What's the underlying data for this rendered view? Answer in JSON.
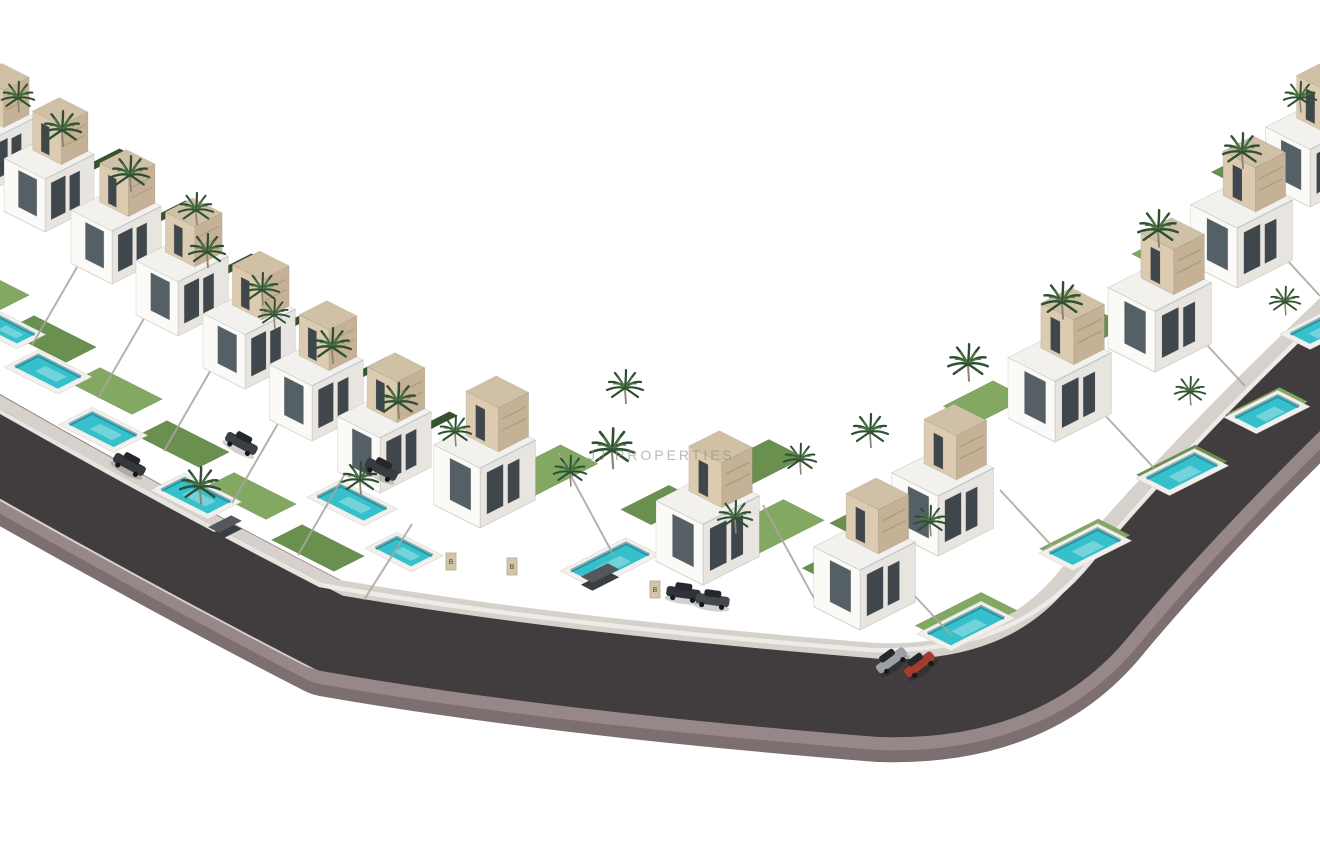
{
  "watermark": {
    "text": "JJ PROPERTIES",
    "color": "#8f8f8f"
  },
  "scene": {
    "background": "#ffffff",
    "road": {
      "path": "M -50 425 Q 140 535 330 633 Q 555 672 880 698 Q 1025 703 1100 610 Q 1200 490 1358 340",
      "surface_color": "#413d3f",
      "curb_color": "#978788",
      "curb_shadow_color": "#7d6e70",
      "sidewalk_color": "#d7d1cb",
      "wall_color": "#efede9"
    },
    "colors": {
      "villa_front": "#fbfaf7",
      "villa_side": "#e8e5e0",
      "villa_roof": "#f3f1ed",
      "tower_front": "#dccbb0",
      "tower_side": "#c5b195",
      "tower_top": "#d0c0a5",
      "window": "#3f464c",
      "window_light": "#545f66",
      "pool_water": "#35c0cb",
      "pool_deck": "#f2f0ed",
      "pool_shade": "rgba(13,104,121,0.5)",
      "lawn_light": "#83a862",
      "lawn_mid": "#69904e",
      "hedge": "#35522f",
      "palm": "#2e4f33",
      "palm_light": "#4e7a44",
      "trunk": "#8d8472",
      "fence": "#a9a5a0",
      "post": "#d3c5a8",
      "post_edge": "#b7a98c",
      "box_dark": "#3b3e41",
      "box_top": "#54585c",
      "wheel": "#17181a",
      "car_glass": "#24282c"
    },
    "villas": [
      {
        "x": -12,
        "y": 192,
        "s": 1.1
      },
      {
        "x": 1310,
        "y": 207,
        "s": 1.25
      },
      {
        "x": 45,
        "y": 232,
        "s": 1.15
      },
      {
        "x": 112,
        "y": 284,
        "s": 1.15
      },
      {
        "x": 1237,
        "y": 288,
        "s": 1.3
      },
      {
        "x": 178,
        "y": 336,
        "s": 1.18
      },
      {
        "x": 1155,
        "y": 372,
        "s": 1.32
      },
      {
        "x": 245,
        "y": 389,
        "s": 1.18
      },
      {
        "x": 312,
        "y": 441,
        "s": 1.2
      },
      {
        "x": 1055,
        "y": 442,
        "s": 1.32
      },
      {
        "x": 380,
        "y": 493,
        "s": 1.2
      },
      {
        "x": 480,
        "y": 528,
        "s": 1.3
      },
      {
        "x": 938,
        "y": 556,
        "s": 1.3
      },
      {
        "x": 703,
        "y": 585,
        "s": 1.32
      },
      {
        "x": 860,
        "y": 630,
        "s": 1.3
      }
    ],
    "pools": [
      {
        "x": 8,
        "y": 330,
        "a": 20,
        "b": 40
      },
      {
        "x": 48,
        "y": 372,
        "a": 26,
        "b": 48
      },
      {
        "x": 103,
        "y": 430,
        "a": 26,
        "b": 50
      },
      {
        "x": 196,
        "y": 496,
        "a": 26,
        "b": 52
      },
      {
        "x": 352,
        "y": 503,
        "a": 26,
        "b": 52
      },
      {
        "x": 404,
        "y": 552,
        "a": 24,
        "b": 40
      },
      {
        "x": 610,
        "y": 563,
        "a": 62,
        "b": 26
      },
      {
        "x": 966,
        "y": 626,
        "a": 60,
        "b": 26
      },
      {
        "x": 1085,
        "y": 547,
        "a": 54,
        "b": 26
      },
      {
        "x": 1182,
        "y": 472,
        "a": 54,
        "b": 26
      },
      {
        "x": 1267,
        "y": 412,
        "a": 48,
        "b": 24
      },
      {
        "x": 1318,
        "y": 330,
        "a": 40,
        "b": 22
      }
    ],
    "lawns": [
      {
        "x": 25,
        "y": 140,
        "a": 44,
        "b": 26,
        "tone": "mid"
      },
      {
        "x": 95,
        "y": 165,
        "a": 64,
        "b": 9,
        "tone": "hedge"
      },
      {
        "x": 161,
        "y": 217,
        "a": 64,
        "b": 9,
        "tone": "hedge"
      },
      {
        "x": 227,
        "y": 270,
        "a": 64,
        "b": 9,
        "tone": "hedge"
      },
      {
        "x": 295,
        "y": 322,
        "a": 64,
        "b": 9,
        "tone": "hedge"
      },
      {
        "x": 361,
        "y": 374,
        "a": 64,
        "b": 9,
        "tone": "hedge"
      },
      {
        "x": 425,
        "y": 428,
        "a": 64,
        "b": 9,
        "tone": "hedge"
      },
      {
        "x": -17,
        "y": 287,
        "a": 34,
        "b": 70,
        "tone": "light"
      },
      {
        "x": 50,
        "y": 339,
        "a": 34,
        "b": 70,
        "tone": "mid"
      },
      {
        "x": 116,
        "y": 391,
        "a": 34,
        "b": 70,
        "tone": "light"
      },
      {
        "x": 183,
        "y": 444,
        "a": 34,
        "b": 70,
        "tone": "mid"
      },
      {
        "x": 250,
        "y": 496,
        "a": 34,
        "b": 70,
        "tone": "light"
      },
      {
        "x": 318,
        "y": 548,
        "a": 34,
        "b": 70,
        "tone": "mid"
      },
      {
        "x": 548,
        "y": 470,
        "a": 70,
        "b": 42,
        "tone": "light"
      },
      {
        "x": 660,
        "y": 505,
        "a": 54,
        "b": 34,
        "tone": "mid"
      },
      {
        "x": 770,
        "y": 527,
        "a": 76,
        "b": 46,
        "tone": "light"
      },
      {
        "x": 835,
        "y": 565,
        "a": 44,
        "b": 30,
        "tone": "mid"
      },
      {
        "x": 760,
        "y": 462,
        "a": 60,
        "b": 40,
        "tone": "mid"
      },
      {
        "x": 966,
        "y": 618,
        "a": 74,
        "b": 40,
        "tone": "light"
      },
      {
        "x": 1085,
        "y": 542,
        "a": 66,
        "b": 36,
        "tone": "light"
      },
      {
        "x": 1182,
        "y": 468,
        "a": 66,
        "b": 36,
        "tone": "mid"
      },
      {
        "x": 1267,
        "y": 408,
        "a": 60,
        "b": 32,
        "tone": "light"
      },
      {
        "x": 1318,
        "y": 328,
        "a": 50,
        "b": 28,
        "tone": "mid"
      },
      {
        "x": 868,
        "y": 520,
        "a": 50,
        "b": 36,
        "tone": "mid"
      },
      {
        "x": 985,
        "y": 402,
        "a": 56,
        "b": 38,
        "tone": "light"
      },
      {
        "x": 1086,
        "y": 330,
        "a": 56,
        "b": 38,
        "tone": "mid"
      },
      {
        "x": 1170,
        "y": 250,
        "a": 52,
        "b": 34,
        "tone": "light"
      },
      {
        "x": 1246,
        "y": 168,
        "a": 48,
        "b": 30,
        "tone": "mid"
      }
    ],
    "fences": [
      {
        "x1": 80,
        "y1": 262,
        "x2": 32,
        "y2": 345
      },
      {
        "x1": 146,
        "y1": 315,
        "x2": 98,
        "y2": 398
      },
      {
        "x1": 212,
        "y1": 368,
        "x2": 164,
        "y2": 451
      },
      {
        "x1": 280,
        "y1": 420,
        "x2": 232,
        "y2": 503
      },
      {
        "x1": 346,
        "y1": 472,
        "x2": 298,
        "y2": 555
      },
      {
        "x1": 412,
        "y1": 524,
        "x2": 364,
        "y2": 600
      },
      {
        "x1": 558,
        "y1": 452,
        "x2": 614,
        "y2": 556
      },
      {
        "x1": 763,
        "y1": 505,
        "x2": 815,
        "y2": 600
      },
      {
        "x1": 900,
        "y1": 580,
        "x2": 952,
        "y2": 636
      },
      {
        "x1": 1000,
        "y1": 490,
        "x2": 1052,
        "y2": 546
      },
      {
        "x1": 1102,
        "y1": 412,
        "x2": 1154,
        "y2": 468
      },
      {
        "x1": 1193,
        "y1": 330,
        "x2": 1245,
        "y2": 386
      },
      {
        "x1": 1276,
        "y1": 248,
        "x2": 1320,
        "y2": 296
      }
    ],
    "palms": [
      {
        "x": 18,
        "y": 98,
        "s": 0.9
      },
      {
        "x": 62,
        "y": 130,
        "s": 1.05
      },
      {
        "x": 130,
        "y": 175,
        "s": 1.05
      },
      {
        "x": 196,
        "y": 210,
        "s": 0.95
      },
      {
        "x": 207,
        "y": 252,
        "s": 1.0
      },
      {
        "x": 262,
        "y": 290,
        "s": 0.95
      },
      {
        "x": 274,
        "y": 315,
        "s": 0.85
      },
      {
        "x": 332,
        "y": 347,
        "s": 1.05
      },
      {
        "x": 398,
        "y": 402,
        "s": 1.05
      },
      {
        "x": 200,
        "y": 487,
        "s": 1.1
      },
      {
        "x": 360,
        "y": 480,
        "s": 1.0
      },
      {
        "x": 455,
        "y": 432,
        "s": 0.9
      },
      {
        "x": 612,
        "y": 450,
        "s": 1.2
      },
      {
        "x": 570,
        "y": 472,
        "s": 0.9
      },
      {
        "x": 625,
        "y": 388,
        "s": 1.0
      },
      {
        "x": 735,
        "y": 518,
        "s": 0.95
      },
      {
        "x": 800,
        "y": 460,
        "s": 0.9
      },
      {
        "x": 870,
        "y": 432,
        "s": 1.0
      },
      {
        "x": 930,
        "y": 522,
        "s": 0.9
      },
      {
        "x": 968,
        "y": 364,
        "s": 1.1
      },
      {
        "x": 1062,
        "y": 302,
        "s": 1.1
      },
      {
        "x": 1158,
        "y": 230,
        "s": 1.1
      },
      {
        "x": 1242,
        "y": 152,
        "s": 1.05
      },
      {
        "x": 1300,
        "y": 98,
        "s": 0.9
      },
      {
        "x": 1190,
        "y": 392,
        "s": 0.85
      },
      {
        "x": 1285,
        "y": 302,
        "s": 0.85
      }
    ],
    "cars": [
      {
        "x": 128,
        "y": 467,
        "rot": 28,
        "color": "#34383c"
      },
      {
        "x": 240,
        "y": 446,
        "rot": 28,
        "color": "#3c4046"
      },
      {
        "x": 380,
        "y": 472,
        "rot": 28,
        "color": "#383d42"
      },
      {
        "x": 683,
        "y": 596,
        "rot": 8,
        "color": "#2f3338"
      },
      {
        "x": 712,
        "y": 603,
        "rot": 8,
        "color": "#45494e"
      },
      {
        "x": 893,
        "y": 663,
        "rot": -36,
        "color": "#9aa0a5"
      },
      {
        "x": 921,
        "y": 667,
        "rot": -36,
        "color": "#a23c30"
      }
    ],
    "boxes": [
      {
        "x": 225,
        "y": 532,
        "a": 26,
        "b": 12
      },
      {
        "x": 600,
        "y": 581,
        "a": 30,
        "b": 13
      }
    ],
    "gate_posts": [
      {
        "x": 451,
        "y": 568,
        "label": "B"
      },
      {
        "x": 512,
        "y": 573,
        "label": "B"
      },
      {
        "x": 655,
        "y": 596,
        "label": "B"
      }
    ]
  }
}
